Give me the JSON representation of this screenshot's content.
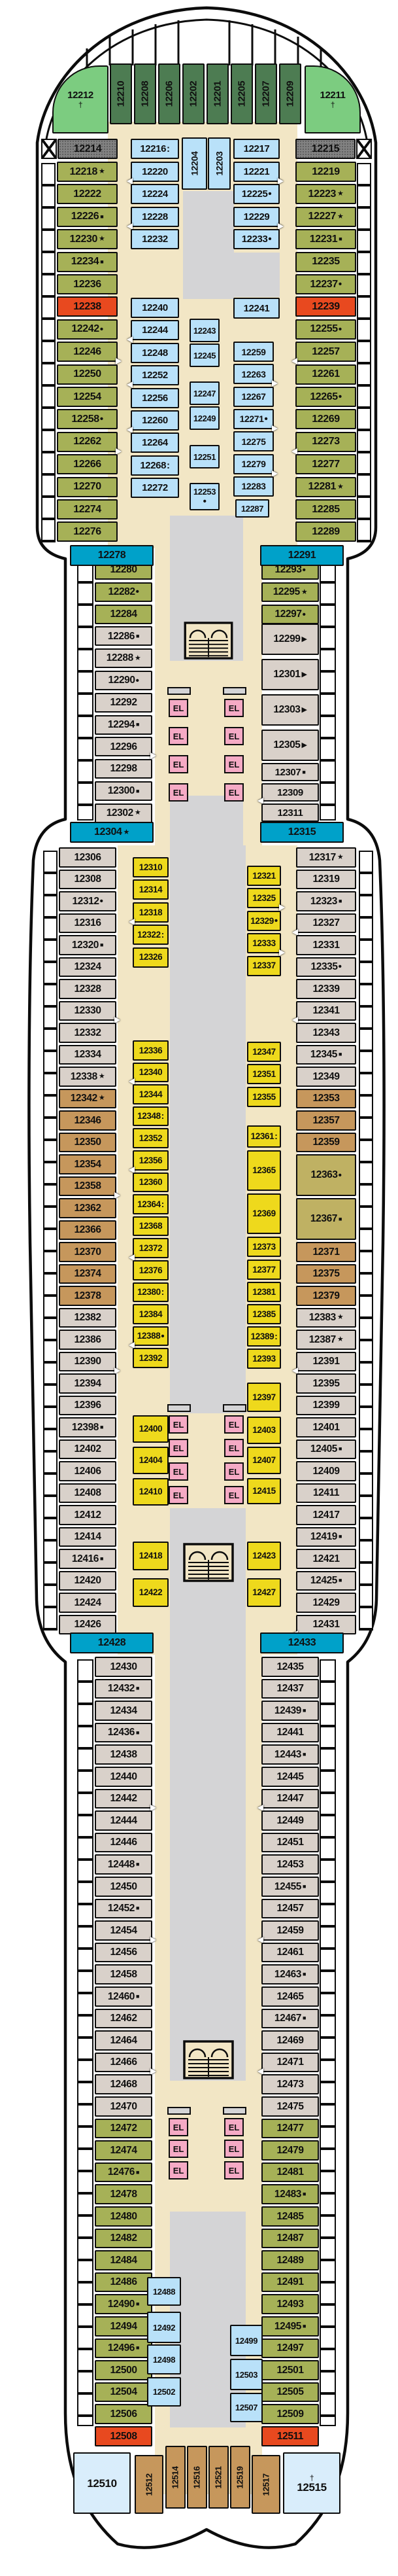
{
  "elevator_label": "EL",
  "colors": {
    "dg": "#4d7c52",
    "lg": "#7ccc80",
    "ol": "#a6b157",
    "bl": "#b9e1f9",
    "rd": "#e8491f",
    "tl": "#00a1c9",
    "tn": "#d9d1ca",
    "br": "#c6975c",
    "kh": "#bfb163",
    "yw": "#eed91c",
    "pb": "#d9edfb",
    "gy": "#828282",
    "pk": "#f5aac5",
    "be": "#f2e6c5",
    "vg": "#d4d4d6"
  },
  "columns": {
    "bow": [
      "12210",
      "12208",
      "12206",
      "12202",
      "12201",
      "12205",
      "12207",
      "12209"
    ],
    "toL": [
      {
        "n": "12218",
        "s": "★"
      },
      "12222",
      {
        "n": "12226",
        "s": "■"
      },
      {
        "n": "12230",
        "s": "★"
      },
      {
        "n": "12234",
        "s": "■"
      },
      "12236",
      {
        "n": "12238",
        "c": "rd"
      },
      {
        "n": "12242",
        "s": "•"
      },
      {
        "n": "12246",
        "d": "r"
      },
      "12250",
      "12254",
      {
        "n": "12258",
        "s": "•"
      },
      {
        "n": "12262",
        "d": "r"
      },
      "12266",
      "12270",
      "12274",
      "12276"
    ],
    "toR": [
      "12219",
      {
        "n": "12223",
        "s": "★"
      },
      {
        "n": "12227",
        "s": "★"
      },
      {
        "n": "12231",
        "s": "■"
      },
      "12235",
      {
        "n": "12237",
        "s": "•"
      },
      {
        "n": "12239",
        "c": "rd"
      },
      {
        "n": "12255",
        "s": "•"
      },
      {
        "n": "12257",
        "d": "l"
      },
      "12261",
      {
        "n": "12265",
        "s": "•"
      },
      "12269",
      {
        "n": "12273",
        "d": "l"
      },
      "12277",
      {
        "n": "12281",
        "s": "★"
      },
      "12285",
      "12289"
    ],
    "tiL1": [
      {
        "n": "12216",
        "s": ":"
      },
      {
        "n": "12220",
        "d": "l"
      },
      "12224",
      {
        "n": "12228",
        "d": "l"
      },
      "12232"
    ],
    "tiL2": [
      "12240",
      {
        "n": "12244",
        "d": "l"
      },
      "12248",
      {
        "n": "12252",
        "d": "l"
      },
      "12256",
      {
        "n": "12260",
        "d": "l"
      },
      "12264",
      {
        "n": "12268",
        "s": ":"
      },
      "12272"
    ],
    "cs": [
      "12243",
      "12245",
      "12247",
      "12249",
      "12251",
      {
        "n": "12253",
        "s": "•",
        "two": 1
      }
    ],
    "tiR1": [
      "12217",
      {
        "n": "12221",
        "d": "r"
      },
      {
        "n": "12225",
        "s": "•"
      },
      {
        "n": "12229",
        "d": "r"
      },
      {
        "n": "12233",
        "s": "•"
      }
    ],
    "tiR2": [
      "12259",
      {
        "n": "12263",
        "d": "r"
      },
      "12267",
      {
        "n": "12271",
        "s": "•",
        "d": "r"
      },
      "12275",
      {
        "n": "12279",
        "d": "r"
      },
      "12283"
    ],
    "naL": [
      "12280",
      {
        "n": "12282",
        "s": "•"
      },
      "12284",
      {
        "n": "12286",
        "s": "■",
        "c": "tn"
      },
      {
        "n": "12288",
        "s": "★",
        "c": "tn"
      },
      {
        "n": "12290",
        "s": "•",
        "c": "tn"
      },
      {
        "n": "12292",
        "c": "tn"
      },
      {
        "n": "12294",
        "s": "■",
        "c": "tn"
      },
      {
        "n": "12296",
        "c": "tn",
        "d": "r"
      },
      {
        "n": "12298",
        "c": "tn"
      },
      {
        "n": "12300",
        "s": "■",
        "c": "tn"
      },
      {
        "n": "12302",
        "s": "★",
        "c": "tn"
      }
    ],
    "naR1": [
      {
        "n": "12293",
        "s": "•"
      },
      {
        "n": "12295",
        "s": "★"
      },
      {
        "n": "12297",
        "s": "•"
      }
    ],
    "naR2": [
      {
        "n": "12299",
        "s": "▶"
      },
      {
        "n": "12301",
        "s": "▶"
      },
      {
        "n": "12303",
        "s": "▶"
      },
      {
        "n": "12305",
        "s": "▶"
      }
    ],
    "naR3": [
      {
        "n": "12307",
        "s": "■"
      },
      {
        "n": "12309",
        "d": "l"
      },
      "12311"
    ],
    "wL": [
      "12306",
      "12308",
      {
        "n": "12312",
        "s": "•"
      },
      "12316",
      {
        "n": "12320",
        "s": "■"
      },
      "12324",
      "12328",
      {
        "n": "12330",
        "d": "r"
      },
      "12332",
      "12334",
      {
        "n": "12338",
        "s": "★"
      },
      {
        "n": "12342",
        "s": "★",
        "c": "br"
      },
      {
        "n": "12346",
        "c": "br"
      },
      {
        "n": "12350",
        "c": "br"
      },
      {
        "n": "12354",
        "c": "br"
      },
      {
        "n": "12358",
        "c": "br",
        "d": "r"
      },
      {
        "n": "12362",
        "c": "br"
      },
      {
        "n": "12366",
        "c": "br"
      },
      {
        "n": "12370",
        "c": "br"
      },
      {
        "n": "12374",
        "c": "br"
      },
      {
        "n": "12378",
        "c": "br"
      },
      "12382",
      "12386",
      {
        "n": "12390",
        "d": "r"
      },
      "12394",
      "12396",
      {
        "n": "12398",
        "s": "■"
      },
      "12402",
      "12406",
      "12408",
      "12412",
      "12414",
      {
        "n": "12416",
        "s": "■"
      },
      "12420",
      "12424",
      "12426"
    ],
    "wR": [
      {
        "n": "12317",
        "s": "★"
      },
      "12319",
      {
        "n": "12323",
        "s": "■"
      },
      {
        "n": "12327",
        "d": "l"
      },
      "12331",
      {
        "n": "12335",
        "s": "•"
      },
      "12339",
      {
        "n": "12341",
        "d": "l"
      },
      "12343",
      {
        "n": "12345",
        "s": "■"
      },
      "12349",
      {
        "n": "12353",
        "c": "br"
      },
      {
        "n": "12357",
        "c": "br"
      },
      {
        "n": "12359",
        "c": "br"
      },
      {
        "n": "12363",
        "s": "•",
        "c": "kh"
      },
      {
        "n": "12367",
        "s": "■",
        "c": "kh"
      },
      {
        "n": "12371",
        "c": "br"
      },
      {
        "n": "12375",
        "c": "br"
      },
      {
        "n": "12379",
        "c": "br"
      },
      {
        "n": "12383",
        "s": "★"
      },
      {
        "n": "12387",
        "s": "★"
      },
      {
        "n": "12391",
        "d": "l"
      },
      "12395",
      "12399",
      "12401",
      {
        "n": "12405",
        "s": "■"
      },
      "12409",
      "12411",
      "12417",
      {
        "n": "12419",
        "s": "■"
      },
      "12421",
      {
        "n": "12425",
        "s": "■"
      },
      "12429",
      {
        "n": "12431",
        "d": "l"
      }
    ],
    "yL1": [
      "12310",
      "12314",
      {
        "n": "12318",
        "d": "l"
      },
      {
        "n": "12322",
        "s": ":"
      },
      "12326"
    ],
    "yL2": [
      "12336",
      {
        "n": "12340",
        "d": "l"
      },
      "12344",
      {
        "n": "12348",
        "s": ":"
      },
      "12352",
      {
        "n": "12356",
        "d": "l"
      },
      "12360",
      {
        "n": "12364",
        "s": ":"
      },
      "12368",
      {
        "n": "12372",
        "d": "l"
      },
      "12376",
      {
        "n": "12380",
        "s": ":"
      },
      "12384",
      {
        "n": "12388",
        "s": "•",
        "d": "l"
      },
      "12392"
    ],
    "yL3": [
      "12400",
      "12404",
      "12410"
    ],
    "yL4": [
      "12418",
      "12422"
    ],
    "yR1": [
      "12321",
      {
        "n": "12325",
        "d": "r"
      },
      {
        "n": "12329",
        "s": "•"
      },
      {
        "n": "12333",
        "d": "r"
      },
      "12337"
    ],
    "yR2": [
      "12347",
      "12351",
      "12355"
    ],
    "yR3": [
      {
        "n": "12361",
        "s": ":"
      },
      "12365",
      "12369",
      "12373"
    ],
    "yR4": [
      "12377",
      "12381",
      "12385",
      {
        "n": "12389",
        "s": ":"
      },
      "12393"
    ],
    "yR5": [
      "12397",
      "12403",
      "12407",
      "12415"
    ],
    "yR6": [
      "12423",
      "12427"
    ],
    "stL": [
      "12430",
      {
        "n": "12432",
        "s": "■"
      },
      "12434",
      {
        "n": "12436",
        "s": "■"
      },
      "12438",
      "12440",
      {
        "n": "12442",
        "d": "r"
      },
      "12444",
      "12446",
      {
        "n": "12448",
        "s": "■"
      },
      "12450",
      {
        "n": "12452",
        "s": "■"
      },
      {
        "n": "12454",
        "d": "r"
      },
      "12456",
      "12458",
      {
        "n": "12460",
        "s": "■"
      },
      "12462",
      "12464",
      {
        "n": "12466",
        "d": "r"
      },
      "12468",
      "12470",
      {
        "n": "12472",
        "c": "ol"
      },
      {
        "n": "12474",
        "c": "ol"
      },
      {
        "n": "12476",
        "s": "■",
        "c": "ol"
      },
      {
        "n": "12478",
        "c": "ol"
      },
      {
        "n": "12480",
        "c": "ol"
      },
      {
        "n": "12482",
        "c": "ol"
      },
      {
        "n": "12484",
        "c": "ol"
      },
      {
        "n": "12486",
        "c": "ol"
      },
      {
        "n": "12490",
        "s": "■",
        "c": "ol"
      },
      {
        "n": "12494",
        "c": "ol"
      },
      {
        "n": "12496",
        "s": "■",
        "c": "ol"
      },
      {
        "n": "12500",
        "c": "ol"
      },
      {
        "n": "12504",
        "c": "ol"
      },
      {
        "n": "12506",
        "c": "ol"
      },
      {
        "n": "12508",
        "c": "rd"
      }
    ],
    "stR": [
      "12435",
      "12437",
      {
        "n": "12439",
        "s": "■"
      },
      "12441",
      {
        "n": "12443",
        "s": "■"
      },
      "12445",
      {
        "n": "12447",
        "d": "l"
      },
      "12449",
      "12451",
      "12453",
      {
        "n": "12455",
        "s": "■"
      },
      "12457",
      {
        "n": "12459",
        "d": "l"
      },
      "12461",
      {
        "n": "12463",
        "s": "■"
      },
      "12465",
      {
        "n": "12467",
        "s": "■"
      },
      "12469",
      {
        "n": "12471",
        "d": "l"
      },
      "12473",
      "12475",
      {
        "n": "12477",
        "c": "ol"
      },
      {
        "n": "12479",
        "c": "ol"
      },
      {
        "n": "12481",
        "c": "ol"
      },
      {
        "n": "12483",
        "s": "■",
        "c": "ol"
      },
      {
        "n": "12485",
        "c": "ol"
      },
      {
        "n": "12487",
        "c": "ol"
      },
      {
        "n": "12489",
        "c": "ol"
      },
      {
        "n": "12491",
        "c": "ol"
      },
      {
        "n": "12493",
        "c": "ol"
      },
      {
        "n": "12495",
        "s": "■",
        "c": "ol"
      },
      {
        "n": "12497",
        "c": "ol"
      },
      {
        "n": "12501",
        "c": "ol"
      },
      {
        "n": "12505",
        "c": "ol"
      },
      {
        "n": "12509",
        "c": "ol"
      },
      {
        "n": "12511",
        "c": "rd"
      }
    ],
    "sbL": [
      "12488",
      "12492",
      "12498",
      "12502"
    ],
    "sbR": [
      "12499",
      "12503",
      "12507"
    ]
  },
  "singles": {
    "12212": {
      "n": "12212",
      "s": "†",
      "two": 1
    },
    "12211": {
      "n": "12211",
      "s": "†",
      "two": 1
    },
    "12214": {
      "n": "12214"
    },
    "12215": {
      "n": "12215"
    },
    "12204": {
      "n": "12204"
    },
    "12203": {
      "n": "12203"
    },
    "12241": {
      "n": "12241"
    },
    "12287": {
      "n": "12287"
    },
    "12278": {
      "n": "12278"
    },
    "12291": {
      "n": "12291"
    },
    "12304": {
      "n": "12304",
      "s": "★"
    },
    "12315": {
      "n": "12315"
    },
    "12428": {
      "n": "12428"
    },
    "12433": {
      "n": "12433"
    },
    "12510": {
      "n": "12510"
    },
    "12515": {
      "n": "12515",
      "s": "†",
      "two": 2
    },
    "12512": {
      "n": "12512"
    },
    "12514": {
      "n": "12514"
    },
    "12516": {
      "n": "12516"
    },
    "12521": {
      "n": "12521"
    },
    "12519": {
      "n": "12519"
    },
    "12517": {
      "n": "12517"
    }
  }
}
